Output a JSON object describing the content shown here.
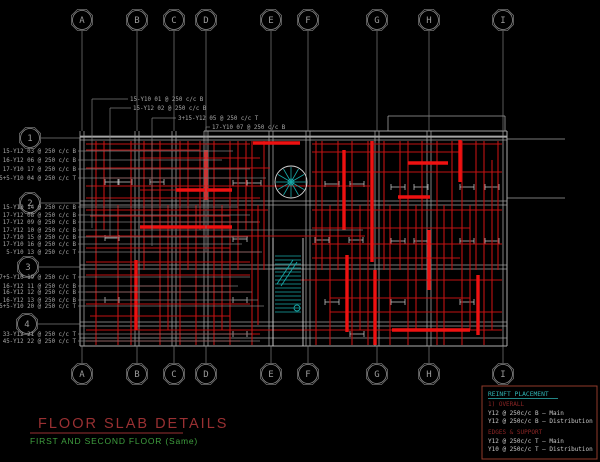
{
  "title": {
    "main": "FLOOR SLAB DETAILS",
    "sub": "FIRST AND SECOND FLOOR  (Same)"
  },
  "legend": {
    "header": "REINFT PLACEMENT",
    "sections": [
      {
        "title": "1) OVERALL",
        "items": [
          "Y12 @ 250c/c B – Main",
          "Y12 @ 250c/c B – Distribution"
        ]
      },
      {
        "title": "EDGES & SUPPORT",
        "items": [
          "Y12 @ 250c/c T – Main",
          "Y10 @ 250c/c T – Distribution"
        ]
      }
    ]
  },
  "colors": {
    "background": "#000000",
    "stem_gray": "#7d7d7d",
    "edge_white": "#d5d5d5",
    "beam_gray": "#9f9f9f",
    "rebar_red": "#bf1212",
    "rebar_red_bright": "#ee1111",
    "cyan": "#18a8a8",
    "title_red": "#993032",
    "subtitle_green": "#3f9f3f",
    "label_gray": "#a8a8a8",
    "legend_border": "#8f3a2a",
    "legend_text": "#c8c8c8",
    "legend_header": "#2fb3b3",
    "legend_section_red": "#8b2525"
  },
  "grid": {
    "columns": [
      {
        "label": "A",
        "x": 82
      },
      {
        "label": "B",
        "x": 137
      },
      {
        "label": "C",
        "x": 174
      },
      {
        "label": "D",
        "x": 206
      },
      {
        "label": "E",
        "x": 271
      },
      {
        "label": "F",
        "x": 308
      },
      {
        "label": "G",
        "x": 377
      },
      {
        "label": "H",
        "x": 429
      },
      {
        "label": "I",
        "x": 503
      }
    ],
    "rows": [
      {
        "label": "1",
        "cx": 30,
        "y": 138
      },
      {
        "label": "2",
        "cx": 30,
        "y": 203
      },
      {
        "label": "3",
        "cx": 28,
        "y": 267
      },
      {
        "label": "4",
        "cx": 27,
        "y": 324
      }
    ],
    "top_cy": 20,
    "bottom_cy": 374
  },
  "annotations": {
    "top": [
      {
        "text": "15-Y10 01 @ 250 c/c B",
        "x": 130,
        "y": 101,
        "turn": 92,
        "drop": 228
      },
      {
        "text": "15-Y12 02 @ 250 c/c B",
        "x": 133,
        "y": 110,
        "turn": 110,
        "drop": 236
      },
      {
        "text": "3+15-Y12 05 @ 250 c/c T",
        "x": 178,
        "y": 120,
        "turn": 152,
        "drop": 246
      },
      {
        "text": "17-Y10 07 @ 250 c/c B",
        "x": 212,
        "y": 129,
        "turn": 206,
        "drop": 252
      }
    ],
    "left": [
      {
        "text": "15-Y12 03 @ 250 c/c B",
        "y": 153,
        "to": 233
      },
      {
        "text": "16-Y12 06 @ 250 c/c B",
        "y": 162,
        "to": 222
      },
      {
        "text": "17-Y10 17 @ 250 c/c B",
        "y": 171,
        "to": 250
      },
      {
        "text": "5+5-Y10 04 @ 250 c/c T",
        "y": 180,
        "to": 266
      },
      {
        "text": "15-Y10 14 @ 250 c/c B",
        "y": 209,
        "to": 238
      },
      {
        "text": "17-Y12 08 @ 250 c/c B",
        "y": 217,
        "to": 250
      },
      {
        "text": "17-Y12 09 @ 250 c/c B",
        "y": 224,
        "to": 258
      },
      {
        "text": "17-Y12 10 @ 250 c/c B",
        "y": 232,
        "to": 363
      },
      {
        "text": "17-Y10 15 @ 250 c/c B",
        "y": 239,
        "to": 248
      },
      {
        "text": "17-Y10 16 @ 250 c/c B",
        "y": 246,
        "to": 242
      },
      {
        "text": "5-Y10 13 @ 250 c/c T",
        "y": 254,
        "to": 262
      },
      {
        "text": "7+5-Y10 19 @ 250 c/c T",
        "y": 279,
        "to": 250
      },
      {
        "text": "16-Y12 11 @ 250 c/c B",
        "y": 288,
        "to": 238
      },
      {
        "text": "16-Y12 12 @ 250 c/c B",
        "y": 294,
        "to": 252
      },
      {
        "text": "16-Y12 13 @ 250 c/c B",
        "y": 302,
        "to": 258
      },
      {
        "text": "5+5-Y10 20 @ 250 c/c T",
        "y": 308,
        "to": 264
      },
      {
        "text": "33-Y12 21 @ 250 c/c T",
        "y": 336,
        "to": 252
      },
      {
        "text": "45-Y12 22 @ 250 c/c T",
        "y": 343,
        "to": 260
      }
    ]
  },
  "drawing": {
    "plan": {
      "left": 80,
      "right": 507,
      "top": 131,
      "bottom": 346
    },
    "beams_v": [
      [
        80,
        84
      ],
      [
        135,
        139
      ],
      [
        172,
        176
      ],
      [
        204,
        208
      ],
      [
        269,
        273
      ],
      [
        306,
        310
      ],
      [
        375,
        379
      ],
      [
        427,
        431
      ],
      [
        503,
        507
      ]
    ],
    "beams_h": [
      [
        136,
        140
      ],
      [
        201,
        205
      ],
      [
        265,
        269
      ],
      [
        322,
        326
      ],
      [
        338,
        346
      ]
    ],
    "top_step": {
      "x1": 388,
      "x2": 505,
      "y": 116
    },
    "ext_lines": [
      [
        507,
        139,
        565,
        139
      ],
      [
        507,
        198,
        565,
        198
      ]
    ],
    "red_v": [
      [
        96,
        141,
        345
      ],
      [
        104,
        141,
        230
      ],
      [
        118,
        205,
        345
      ],
      [
        131,
        141,
        345
      ],
      [
        144,
        141,
        270
      ],
      [
        152,
        141,
        230
      ],
      [
        160,
        141,
        345
      ],
      [
        168,
        205,
        330
      ],
      [
        180,
        141,
        345
      ],
      [
        188,
        141,
        270
      ],
      [
        196,
        205,
        345
      ],
      [
        200,
        141,
        230
      ],
      [
        214,
        141,
        345
      ],
      [
        222,
        205,
        330
      ],
      [
        230,
        141,
        345
      ],
      [
        238,
        141,
        270
      ],
      [
        246,
        141,
        230
      ],
      [
        252,
        141,
        345
      ],
      [
        258,
        205,
        325
      ],
      [
        264,
        141,
        270
      ],
      [
        316,
        141,
        345
      ],
      [
        322,
        141,
        270
      ],
      [
        330,
        205,
        345
      ],
      [
        338,
        141,
        270
      ],
      [
        352,
        141,
        345
      ],
      [
        360,
        205,
        330
      ],
      [
        368,
        141,
        345
      ],
      [
        384,
        141,
        270
      ],
      [
        390,
        205,
        345
      ],
      [
        400,
        141,
        270
      ],
      [
        408,
        141,
        345
      ],
      [
        416,
        205,
        330
      ],
      [
        422,
        141,
        270
      ],
      [
        437,
        141,
        345
      ],
      [
        444,
        205,
        345
      ],
      [
        452,
        141,
        270
      ],
      [
        462,
        141,
        345
      ],
      [
        470,
        205,
        330
      ],
      [
        476,
        141,
        270
      ],
      [
        484,
        141,
        345
      ],
      [
        492,
        160,
        330
      ],
      [
        498,
        141,
        270
      ]
    ],
    "red_h": [
      [
        144,
        86,
        250
      ],
      [
        144,
        312,
        502
      ],
      [
        150,
        86,
        200
      ],
      [
        152,
        312,
        460
      ],
      [
        158,
        140,
        260
      ],
      [
        168,
        86,
        270
      ],
      [
        172,
        312,
        502
      ],
      [
        178,
        100,
        240
      ],
      [
        186,
        86,
        370
      ],
      [
        190,
        140,
        230
      ],
      [
        198,
        86,
        260
      ],
      [
        210,
        86,
        268
      ],
      [
        210,
        312,
        502
      ],
      [
        216,
        90,
        230
      ],
      [
        222,
        140,
        260
      ],
      [
        228,
        312,
        470
      ],
      [
        236,
        86,
        365
      ],
      [
        244,
        312,
        502
      ],
      [
        248,
        86,
        230
      ],
      [
        252,
        140,
        260
      ],
      [
        258,
        312,
        460
      ],
      [
        262,
        86,
        250
      ],
      [
        275,
        86,
        250
      ],
      [
        280,
        300,
        502
      ],
      [
        286,
        140,
        230
      ],
      [
        292,
        86,
        250
      ],
      [
        298,
        330,
        470
      ],
      [
        304,
        86,
        250
      ],
      [
        312,
        330,
        502
      ],
      [
        316,
        90,
        230
      ],
      [
        330,
        86,
        502
      ],
      [
        334,
        140,
        260
      ],
      [
        341,
        86,
        240
      ]
    ],
    "red_thick": [
      [
        140,
        227,
        232,
        227
      ],
      [
        408,
        163,
        448,
        163
      ],
      [
        398,
        197,
        430,
        197
      ],
      [
        344,
        150,
        344,
        230
      ],
      [
        347,
        255,
        347,
        332
      ],
      [
        372,
        141,
        372,
        262
      ],
      [
        375,
        270,
        375,
        345
      ],
      [
        460,
        140,
        460,
        182
      ],
      [
        478,
        275,
        478,
        335
      ],
      [
        392,
        330,
        470,
        330
      ],
      [
        253,
        143,
        300,
        143
      ],
      [
        176,
        190,
        232,
        190
      ],
      [
        136,
        260,
        136,
        330
      ],
      [
        206,
        150,
        206,
        200
      ],
      [
        429,
        230,
        429,
        290
      ]
    ],
    "ticks": [
      [
        112,
        182
      ],
      [
        125,
        182
      ],
      [
        157,
        182
      ],
      [
        240,
        183
      ],
      [
        254,
        183
      ],
      [
        332,
        184
      ],
      [
        357,
        184
      ],
      [
        398,
        187
      ],
      [
        421,
        187
      ],
      [
        467,
        187
      ],
      [
        492,
        187
      ],
      [
        112,
        238
      ],
      [
        240,
        239
      ],
      [
        322,
        240
      ],
      [
        356,
        240
      ],
      [
        398,
        241
      ],
      [
        421,
        241
      ],
      [
        467,
        241
      ],
      [
        492,
        241
      ],
      [
        112,
        300
      ],
      [
        240,
        300
      ],
      [
        332,
        302
      ],
      [
        398,
        302
      ],
      [
        467,
        302
      ],
      [
        240,
        334
      ],
      [
        357,
        334
      ]
    ],
    "spiral": {
      "cx": 291,
      "cy": 182,
      "r": 16,
      "spokes": 12
    },
    "stair": {
      "x1": 275,
      "x2": 301,
      "wall1": 273,
      "wall2": 303,
      "wall_top": 238,
      "tread_top": 256,
      "tread_bottom": 312,
      "tread_step": 4
    }
  }
}
